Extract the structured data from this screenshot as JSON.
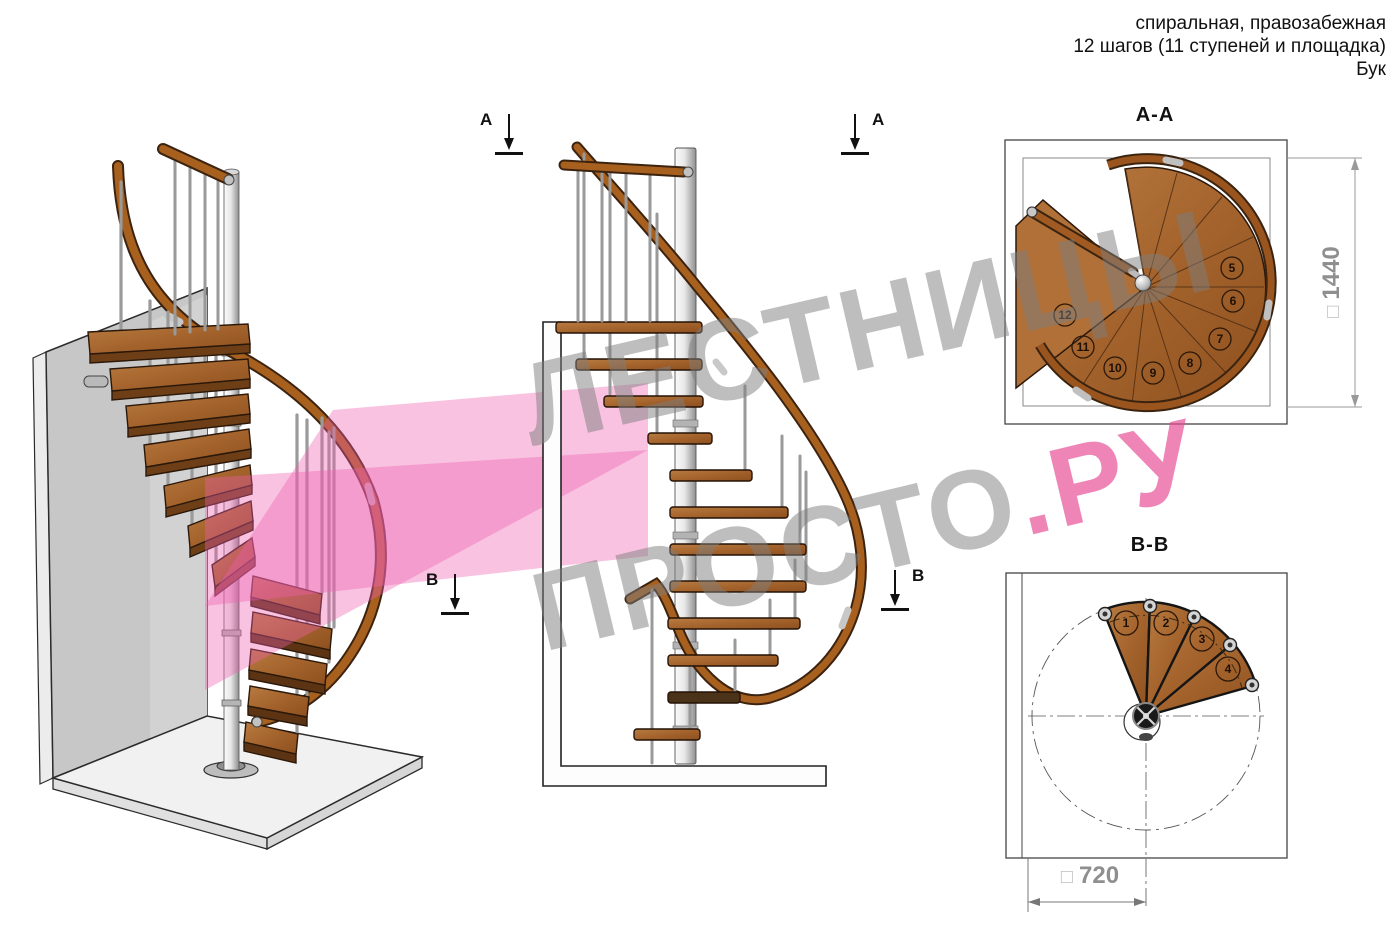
{
  "header": {
    "line1": "спиральная, правозабежная",
    "line2": "12 шагов (11 ступеней и площадка)",
    "line3": "Бук"
  },
  "watermark": {
    "line1": "ЛЕСТНИЦЫ",
    "line2_gray": "ПРОСТО",
    "line2_pink": ".РУ"
  },
  "sections": {
    "a": "А",
    "b": "В"
  },
  "plan_aa": {
    "title": "А-А",
    "dim_square": "□",
    "dim_value": "1440",
    "step_numbers": [
      "5",
      "6",
      "7",
      "8",
      "9",
      "10",
      "11",
      "12"
    ]
  },
  "plan_bb": {
    "title": "В-В",
    "dim_square": "□",
    "dim_value": "720",
    "step_numbers": [
      "1",
      "2",
      "3",
      "4"
    ]
  },
  "colors": {
    "accent_pink": "#e84b94",
    "wood": "#a96a33",
    "metal": "#c9c9c9",
    "watermark_gray": "#7d7d7d"
  }
}
